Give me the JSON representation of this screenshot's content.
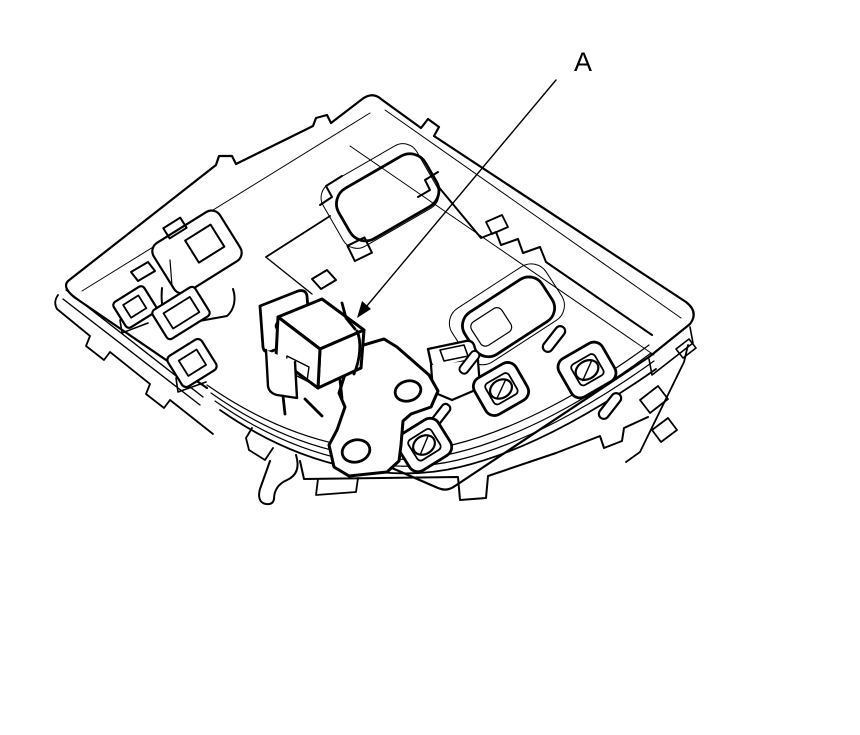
{
  "canvas": {
    "width": 860,
    "height": 735,
    "background": "#ffffff",
    "line_color": "#000000"
  },
  "callout": {
    "label": "A"
  }
}
